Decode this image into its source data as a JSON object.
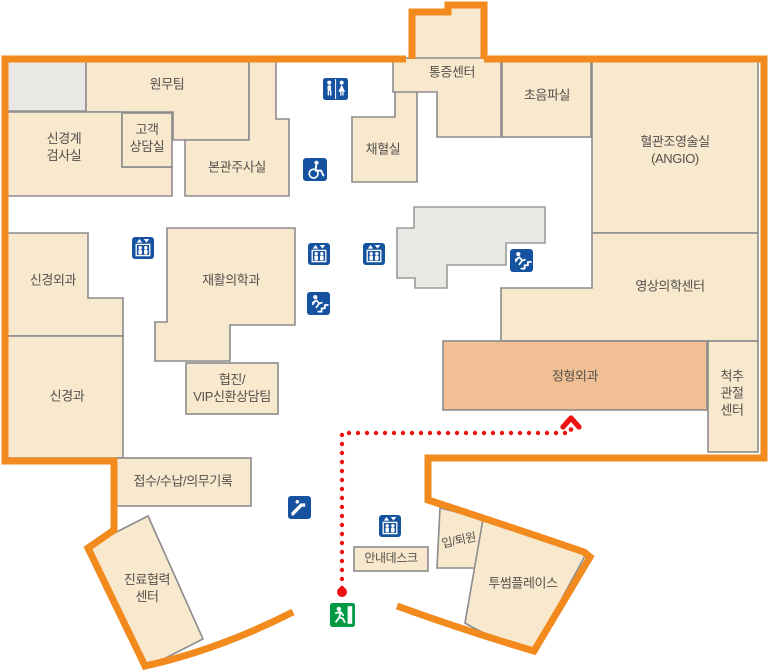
{
  "map": {
    "kind": "hospital-floor-plan",
    "colors": {
      "building_outline": "#f28a1e",
      "room_fill": "#f7e8ce",
      "highlighted_room_fill": "#f0bf93",
      "wall": "#8c8c8c",
      "unlabeled_area_fill": "#e9e8e4",
      "facility_icon_blue": "#1553a0",
      "exit_green": "#009a44",
      "route_red": "#ee1111",
      "label_text": "#55514c"
    },
    "rooms": {
      "admin_team": {
        "label": "원무팀"
      },
      "neuro_exam": {
        "label": "신경계\n검사실"
      },
      "customer_consult": {
        "label": "고객\n상담실"
      },
      "main_injection": {
        "label": "본관주사실"
      },
      "blood_collection": {
        "label": "채혈실"
      },
      "pain_center": {
        "label": "통증센터"
      },
      "ultrasound": {
        "label": "초음파실"
      },
      "angio": {
        "label": "혈관조영술실\n(ANGIO)"
      },
      "neurosurgery": {
        "label": "신경외과"
      },
      "rehab_medicine": {
        "label": "재활의학과"
      },
      "imaging_center": {
        "label": "영상의학센터"
      },
      "neurology": {
        "label": "신경과"
      },
      "vip_consult": {
        "label": "협진/\nVIP신환상담팀"
      },
      "orthopedics": {
        "label": "정형외과",
        "highlighted": true
      },
      "spine_joint": {
        "label": "척추\n관절\n센터"
      },
      "reception": {
        "label": "접수/수납/의무기록"
      },
      "care_coop": {
        "label": "진료협력\n센터"
      },
      "info_desk": {
        "label": "안내데스크"
      },
      "admission": {
        "label": "입/퇴원"
      },
      "twosome_place": {
        "label": "투썸플레이스"
      }
    },
    "icons": {
      "restroom": "restroom-icon",
      "wheelchair": "wheelchair-icon",
      "elevator": "elevator-icon",
      "stairs": "stairs-icon",
      "escalator": "escalator-icon",
      "emergency_exit": "exit-icon"
    },
    "route": {
      "style": "red-dotted",
      "from": "exit-icon",
      "to_room": "정형외과"
    }
  }
}
